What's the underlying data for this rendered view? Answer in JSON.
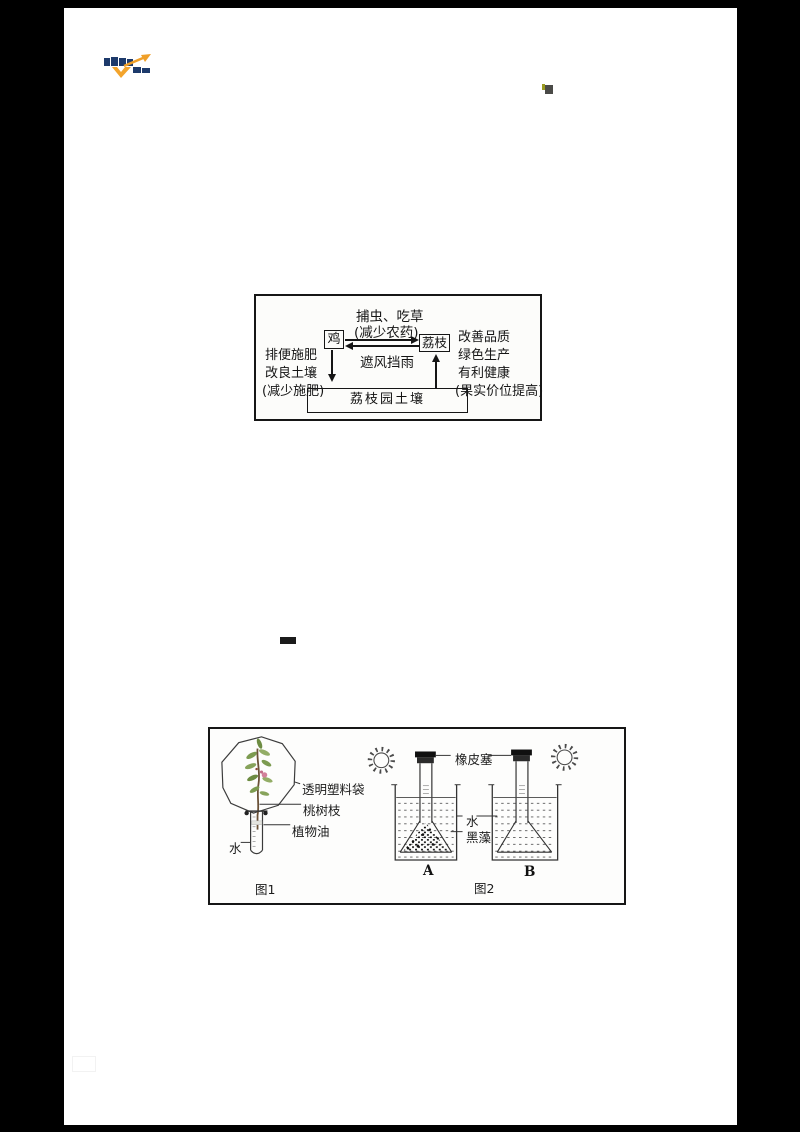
{
  "document": {
    "paper_color": "#ffffff",
    "frame_color": "#000000",
    "ink_color": "#1a1a1a"
  },
  "branding": {
    "logo": "xuekewang-logo",
    "navy": "#1d3a6b",
    "orange": "#f2a32b"
  },
  "corner_mark": {
    "tick_color": "#9a9a20",
    "square_color": "#4a4a47"
  },
  "redaction_dash": {
    "color": "#1b1b1b"
  },
  "ecosystem_diagram": {
    "top_line1": "捕虫、吃草",
    "top_line2": "(减少农药)",
    "chicken": "鸡",
    "lychee": "荔枝",
    "mid_label": "遮风挡雨",
    "left_lines": [
      "排便施肥",
      "改良土壤",
      "(减少施肥)"
    ],
    "right_lines": [
      "改善品质",
      "绿色生产",
      "有利健康",
      "(果实价位提高)"
    ],
    "soil_box": "荔枝园土壤"
  },
  "experiment_figure": {
    "fig1": {
      "label_bag": "透明塑料袋",
      "label_twig": "桃树枝",
      "label_oil": "植物油",
      "label_water": "水",
      "caption": "图1",
      "leaf_green": "#7c9b50",
      "flower_pink": "#d2809a"
    },
    "fig2": {
      "label_stopper": "橡皮塞",
      "label_water": "水",
      "label_algae": "黑藻",
      "beaker_a_label": "A",
      "beaker_b_label": "B",
      "caption": "图2"
    }
  }
}
